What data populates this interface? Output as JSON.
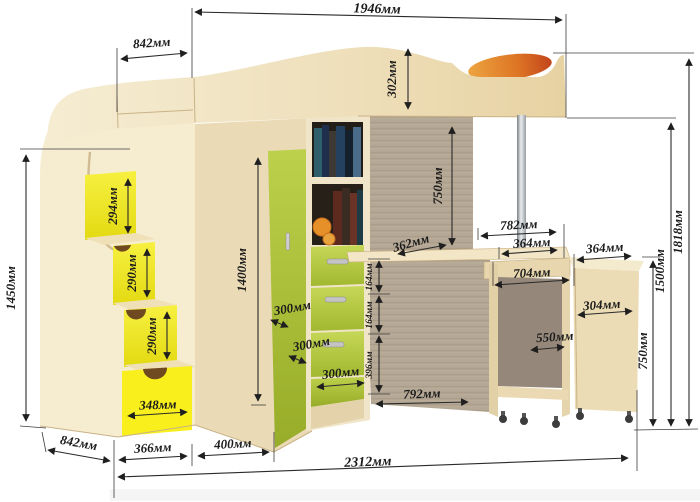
{
  "drawing": {
    "subject": "loft-bed-with-wardrobe-stairs-and-desk",
    "unit": "мм",
    "colors": {
      "wood_light": "#f2e7cb",
      "wood_mid": "#e9d9b4",
      "wood_dark_texture": "#b3a694",
      "accent_green": "#afc436",
      "accent_yellow": "#f2ea1f",
      "pillow_orange": "#d96a22",
      "dimension_line": "#2a2a2a"
    }
  },
  "dims": {
    "top_length": "1946мм",
    "top_depth": "842мм",
    "headboard_height": "302мм",
    "left_height": "1450мм",
    "step_1": "294мм",
    "step_2": "290мм",
    "step_3": "290мм",
    "step_drawer": "348мм",
    "bottom_left_depth": "842мм",
    "base_1": "366мм",
    "base_2": "400мм",
    "total_width": "2312мм",
    "wardrobe_height": "1400мм",
    "door_width_1": "300мм",
    "door_width_2": "300мм",
    "door_width_3": "300мм",
    "desk_depth": "362мм",
    "underbed_clearance": "750мм",
    "desk_span": "782мм",
    "desk_half": "364мм",
    "cart_width": "704мм",
    "cabinet_top_depth": "364мм",
    "cabinet_width": "304мм",
    "cart_depth": "550мм",
    "cabinet_height": "750мм",
    "bed_platform_height": "1500мм",
    "total_height": "1818мм",
    "desk_area_depth": "792мм",
    "drawer_height_1": "164мм",
    "drawer_height_2": "164мм",
    "lower_door_height": "396мм"
  }
}
